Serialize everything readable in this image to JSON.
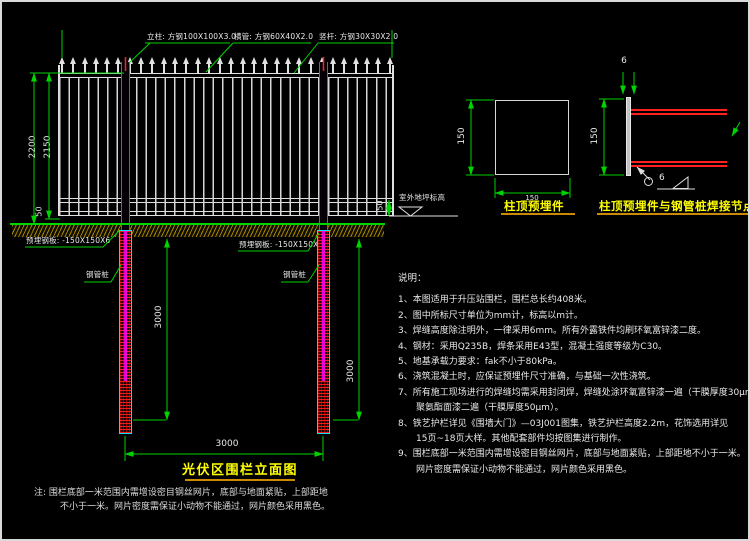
{
  "colors": {
    "background": "#000000",
    "line-green": "#00d400",
    "line-white": "#e0e0e0",
    "post-magenta": "#ff00ff",
    "pile-cyan": "#00e5ff",
    "steel-red": "#ff2020",
    "title-yellow": "#ffff00",
    "underline-orange": "#cc8a00",
    "soil-yellow": "#8a7200",
    "text": "#e8e8e8"
  },
  "callouts": {
    "post": "立柱: 方钢100X100X3.0",
    "rail": "横管: 方钢60X40X2.0",
    "picket": "竖杆: 方钢30X30X2.0",
    "embed_plate_left": "预埋钢板: -150X150X6",
    "embed_plate_right": "预埋钢板: -150X150X6",
    "pile_left": "钢管桩",
    "pile_right": "钢管桩",
    "ground_level": "室外地坪标高"
  },
  "dimensions": {
    "fence_height_total": "2200",
    "fence_height_panel": "2150",
    "clearance_left": "50",
    "clearance_right": "50",
    "pile_depth_left": "3000",
    "pile_depth_right": "3000",
    "post_spacing": "3000",
    "plate_side_vertical": "150",
    "plate_side_horizontal": "150",
    "weld_plate_height": "150",
    "plate_thickness": "6",
    "weld_leg_size": "6"
  },
  "details": {
    "embed_plate_label": "柱顶预埋件",
    "weld_node_label": "柱顶预埋件与钢管桩焊接节点"
  },
  "title_block": {
    "title": "光伏区围栏立面图",
    "note_line1": "注: 围栏底部一米范围内需增设密目钢丝网片，底部与地面紧贴，上部距地",
    "note_line2": "不小于一米。网片密度需保证小动物不能通过，网片颜色采用黑色。"
  },
  "notes": {
    "heading": "说明：",
    "lines": [
      "1、本图适用于升压站围栏，围栏总长约408米。",
      "2、图中所标尺寸单位为mm计，标高以m计。",
      "3、焊缝高度除注明外，一律采用6mm。所有外露铁件均刷环氧富锌漆二度。",
      "4、钢材：采用Q235B，焊条采用E43型，混凝土强度等级为C30。",
      "5、地基承载力要求：fak不小于80kPa。",
      "6、浇筑混凝土时，应保证预埋件尺寸准确，与基础一次性浇筑。",
      "7、所有施工现场进行的焊缝均需采用封闭焊，焊缝处涂环氧富锌漆一遍（干膜厚度30μm），",
      "　　聚氨酯面漆二遍（干膜厚度50μm）。",
      "8、铁艺护栏详见《围墙大门》—03J001图集，铁艺护栏高度2.2m，花饰选用详见",
      "　　15页~18页大样。其他配套部件均按图集进行制作。",
      "9、围栏底部一米范围内需增设密目钢丝网片，底部与地面紧贴，上部距地不小于一米。",
      "　　网片密度需保证小动物不能通过，网片颜色采用黑色。"
    ]
  }
}
